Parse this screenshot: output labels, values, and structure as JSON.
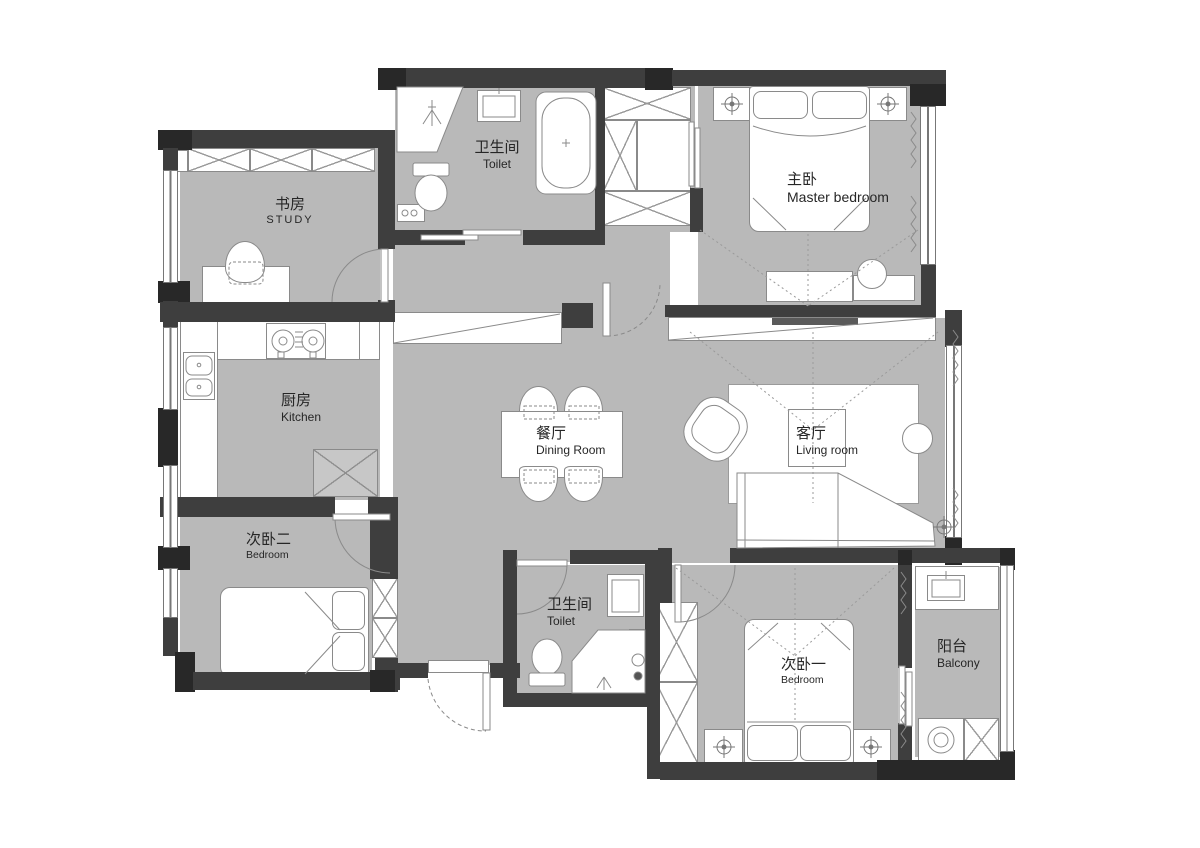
{
  "plan": {
    "rooms": [
      {
        "zh": "书房",
        "en": "STUDY"
      },
      {
        "zh": "卫生间",
        "en": "Toilet"
      },
      {
        "zh": "主卧",
        "en": "Master bedroom"
      },
      {
        "zh": "厨房",
        "en": "Kitchen"
      },
      {
        "zh": "餐厅",
        "en": "Dining Room"
      },
      {
        "zh": "客厅",
        "en": "Living room"
      },
      {
        "zh": "次卧二",
        "en": "Bedroom"
      },
      {
        "zh": "卫生间",
        "en": "Toilet"
      },
      {
        "zh": "次卧一",
        "en": "Bedroom"
      },
      {
        "zh": "阳台",
        "en": "Balcony"
      }
    ],
    "colors": {
      "floor": "#b9b9b9",
      "wall": "#3e3e3e",
      "wall_dark": "#282828",
      "line": "#8a8a8a"
    }
  }
}
